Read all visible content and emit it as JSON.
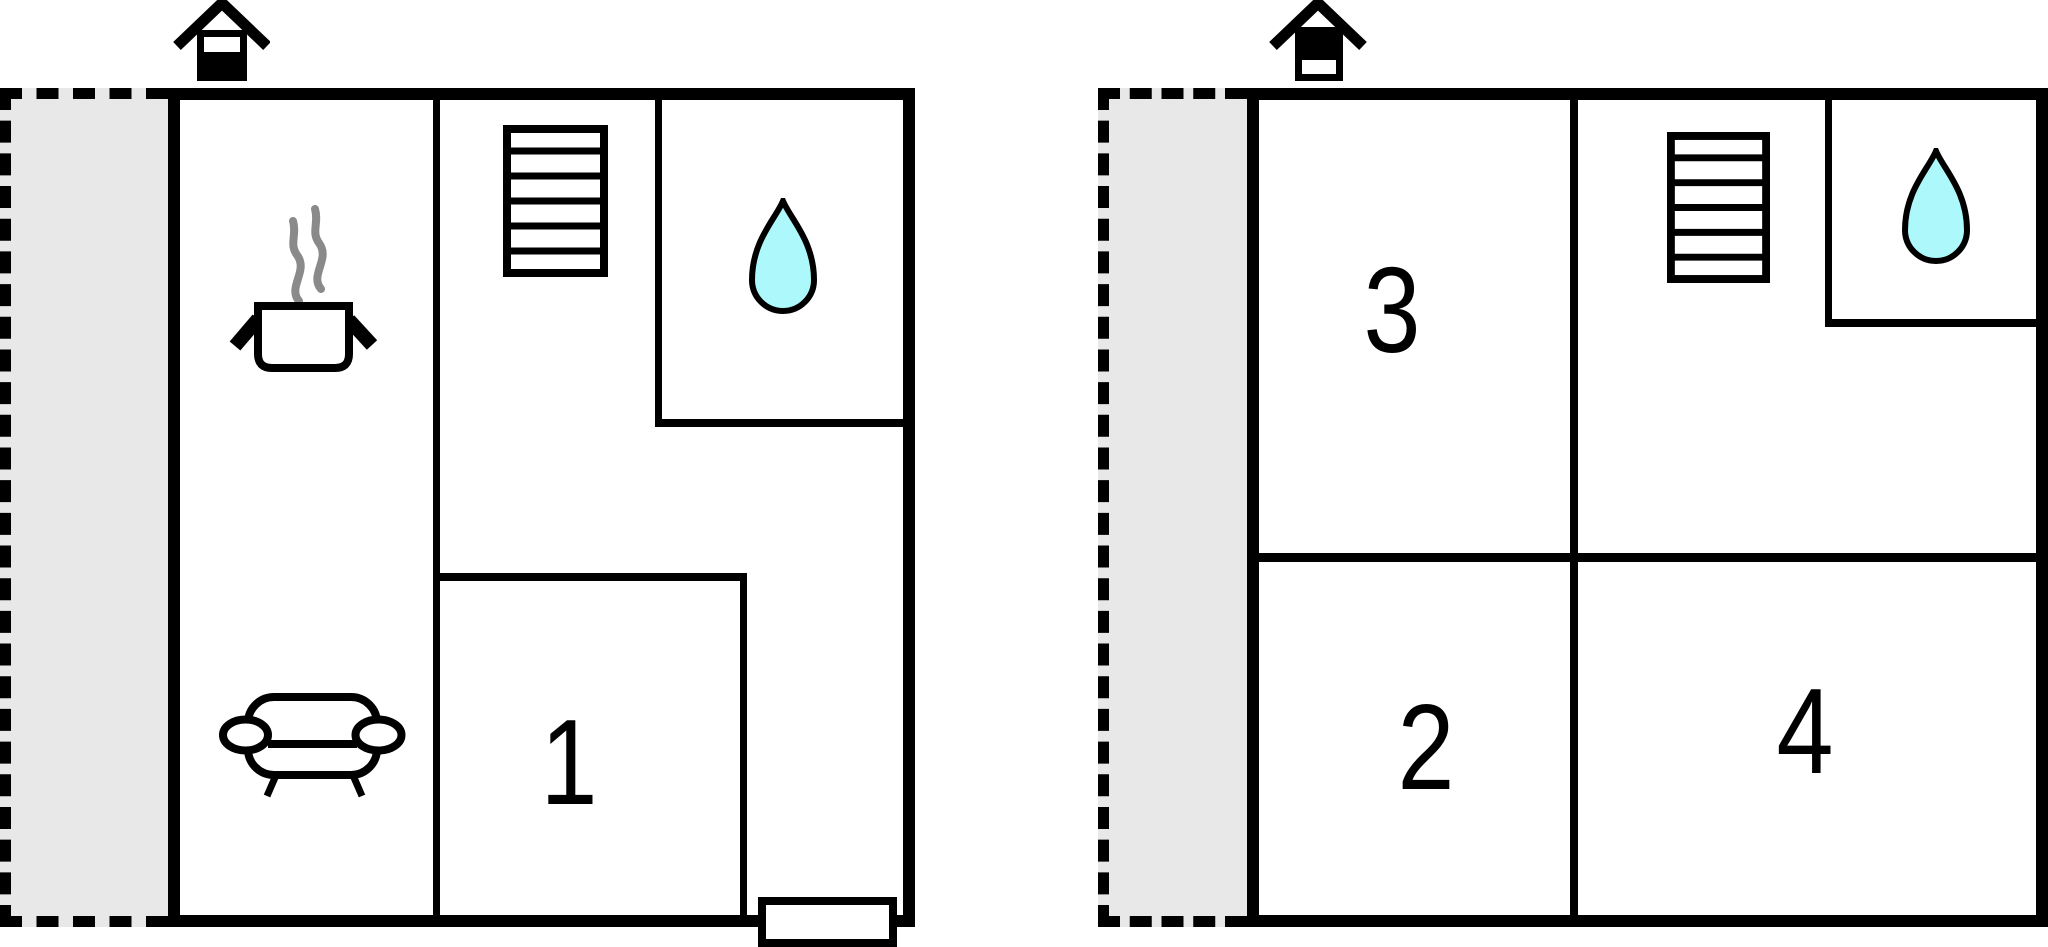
{
  "palette": {
    "wall": "#000000",
    "paper": "#ffffff",
    "terrace": "#e8e8e8",
    "water": "#adf8fb",
    "steam": "#8a8a8a"
  },
  "floors": [
    {
      "id": "floor-a",
      "rooms": {
        "room1": "1"
      },
      "features": [
        "terrace",
        "fireplace-chimney",
        "staircase",
        "water-drop",
        "cooking-pot",
        "sofa",
        "entrance-step"
      ]
    },
    {
      "id": "floor-b",
      "rooms": {
        "room2": "2",
        "room3": "3",
        "room4": "4"
      },
      "features": [
        "terrace",
        "fireplace-chimney",
        "staircase",
        "water-drop"
      ]
    }
  ]
}
